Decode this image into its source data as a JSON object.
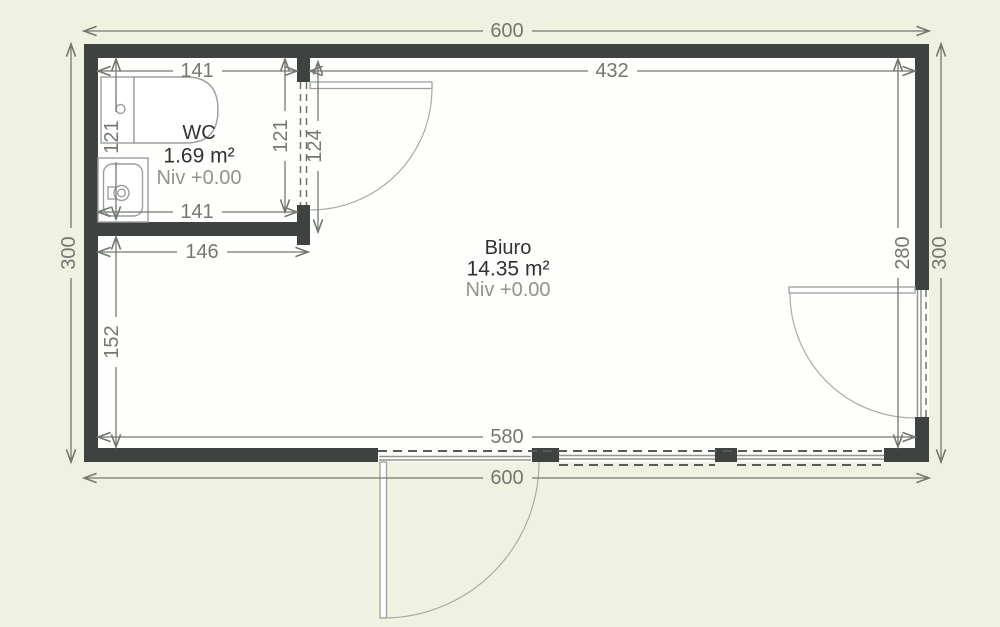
{
  "plan": {
    "type": "floor-plan",
    "background_color": "#eff2e0",
    "wall_color": "#3e4240",
    "dimension_color": "#737871",
    "fixture_line_color": "#9ba09b",
    "room_label_color": "#2e3230",
    "level_label_color": "#8f948e"
  },
  "rooms": [
    {
      "name": "WC",
      "area": "1.69 m²",
      "level": "Niv +0.00"
    },
    {
      "name": "Biuro",
      "area": "14.35 m²",
      "level": "Niv +0.00"
    }
  ],
  "dimensions": {
    "overall_width_top": "600",
    "biuro_width": "432",
    "wc_width_top": "141",
    "wc_width_bottom": "141",
    "wc_height_left": "121",
    "wc_height_right": "121",
    "wc_door_side": "124",
    "wc_south_width": "146",
    "left_lower_height": "152",
    "overall_height_left": "300",
    "biuro_inner_height": "280",
    "overall_height_right": "300",
    "inner_width_bottom": "580",
    "overall_width_bottom": "600"
  }
}
